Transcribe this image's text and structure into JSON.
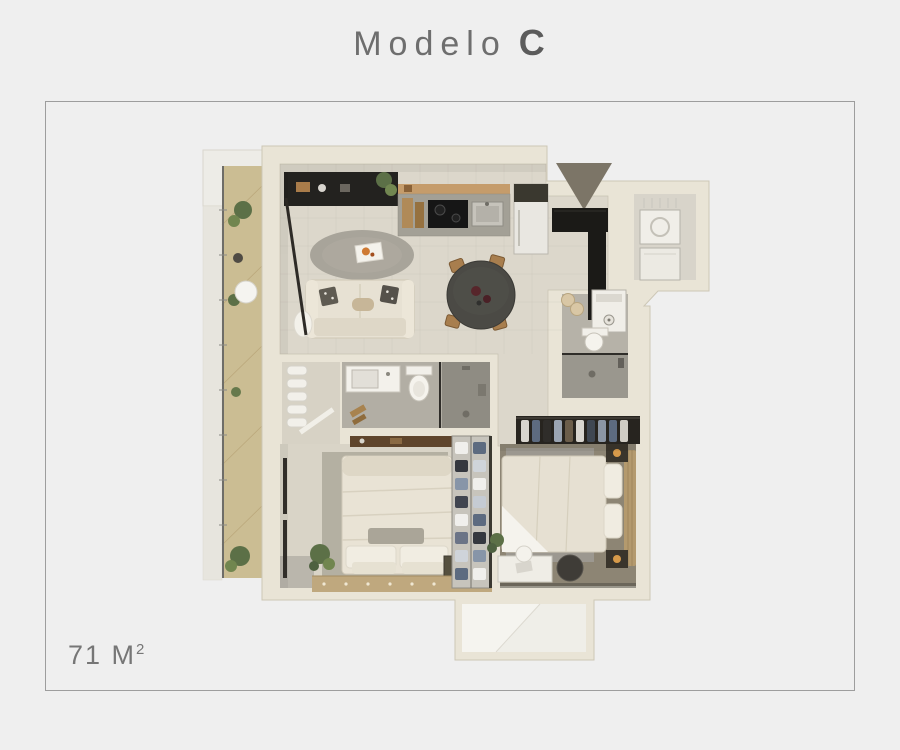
{
  "title": {
    "main": "Modelo",
    "variant": "C"
  },
  "area": {
    "value": "71 M",
    "superscript": "2"
  },
  "frame": {
    "border_color": "#9d9d9d"
  },
  "colors": {
    "background": "#efefef",
    "title_text": "#6e6e6e",
    "area_text": "#767676",
    "wall": "#e9e4d6",
    "living_floor": "#dcd7cb",
    "balcony_floor": "#cbbd93",
    "bedroom2_floor": "#8d8574",
    "bathroom_floor": "#b2aea4",
    "entrance_arrow": "#7c7567",
    "dark_furniture": "#1b1a17"
  },
  "floor_plan": {
    "kind": "apartment-top-view-render",
    "entrance_marker": "triangle-down-arrow",
    "rooms": [
      "balcony",
      "living-room",
      "kitchen",
      "dining-area",
      "entry",
      "utility-room",
      "guest-bathroom",
      "main-bathroom",
      "bedroom-1",
      "bedroom-2",
      "closet",
      "terrace"
    ]
  }
}
